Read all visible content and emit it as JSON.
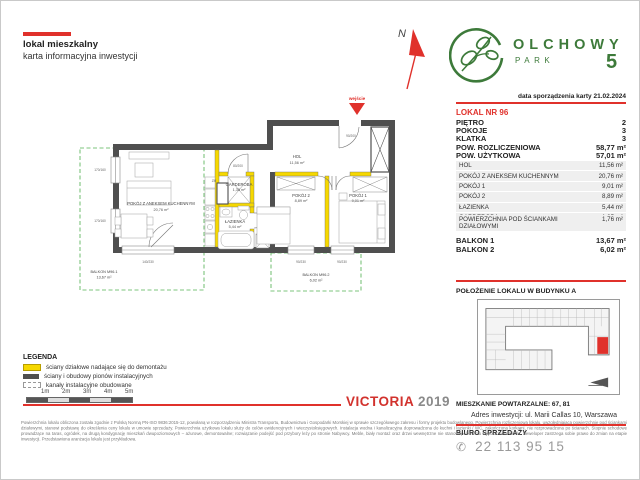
{
  "colors": {
    "accent_red": "#e0312b",
    "brand_green": "#3d7a3a",
    "wall_yellow": "#f6d800",
    "wall_gray": "#4f4f4f",
    "balcony_green": "#7cc47c"
  },
  "header": {
    "doc_type_line1": "lokal mieszkalny",
    "doc_type_line2": "karta informacyjna inwestycji",
    "compass_label": "N",
    "date_label": "data sporządzenia karty 21.02.2024"
  },
  "brand": {
    "name": "OLCHOWY",
    "sub": "PARK",
    "number": "5"
  },
  "panel": {
    "unit_title": "LOKAL NR 96",
    "summary_rows": [
      {
        "label": "PIĘTRO",
        "value": "2"
      },
      {
        "label": "POKOJE",
        "value": "3"
      },
      {
        "label": "KLATKA",
        "value": "3"
      },
      {
        "label": "POW. ROZLICZENIOWA",
        "value": "58,77 m²"
      },
      {
        "label": "POW. UŻYTKOWA",
        "value": "57,01 m²"
      }
    ],
    "room_rows": [
      {
        "label": "HOL",
        "value": "11,56 m²"
      },
      {
        "label": "POKÓJ Z ANEKSEM KUCHENNYM",
        "value": "20,76 m²"
      },
      {
        "label": "POKÓJ 1",
        "value": "9,01 m²"
      },
      {
        "label": "POKÓJ 2",
        "value": "8,89 m²"
      },
      {
        "label": "ŁAZIENKA",
        "value": "5,44 m²"
      },
      {
        "label": "GARDEROBA",
        "value": "1,35 m²"
      }
    ],
    "partition_row": {
      "label": "POWIERZCHNIA POD ŚCIANKAMI DZIAŁOWYMI",
      "value": "1,76 m²"
    },
    "balcony_rows": [
      {
        "label": "BALKON 1",
        "value": "13,67 m²"
      },
      {
        "label": "BALKON 2",
        "value": "6,02 m²"
      }
    ],
    "location_title": "POŁOŻENIE LOKALU W BUDYNKU A",
    "repeatable": "MIESZKANIE POWTARZALNE: 67, 81",
    "address": "Adres inwestycji: ul. Marii Callas 10, Warszawa",
    "sales_office_label": "BIURO SPRZEDAŻY",
    "phone": "22 113 95 15",
    "phone_icon": "✆"
  },
  "floorplan": {
    "entrance_label": "wejście",
    "kitchen_label": "ZM",
    "rooms": [
      {
        "name": "POKÓJ Z ANEKSEM KUCHENNYM",
        "area": "20,76 m²"
      },
      {
        "name": "HOL",
        "area": "11,56 m²"
      },
      {
        "name": "GARDEROBA",
        "area": "1,35 m²"
      },
      {
        "name": "ŁAZIENKA",
        "area": "5,44 m²"
      },
      {
        "name": "POKÓJ 2",
        "area": "8,89 m²"
      },
      {
        "name": "POKÓJ 1",
        "area": "9,01 m²"
      }
    ],
    "balcony1": {
      "label": "BALKON M96.1",
      "area": "13,67 m²"
    },
    "balcony2": {
      "label": "BALKON M96.2",
      "area": "6,02 m²"
    },
    "dims": [
      "170/160",
      "170/160",
      "140/230",
      "90/230",
      "90/230",
      "80/200",
      "90/200"
    ]
  },
  "legend": {
    "title": "LEGENDA",
    "items": [
      "ściany działowe nadające się do demontażu",
      "ściany i obudowy pionów instalacyjnych",
      "kanały instalacyjne obudowane"
    ],
    "scale_ticks": [
      "1m",
      "2m",
      "3m",
      "4m",
      "5m"
    ]
  },
  "victoria": {
    "brand": "VICTORIA",
    "year": "2019"
  },
  "footer_text": "Powierzchnia lokalu obliczona została zgodnie z Polską Normą PN-ISO 9836:2015-12, powołaną w rozporządzeniu Ministra Transportu, Budownictwa i Gospodarki Morskiej w sprawie szczegółowego zakresu i formy projektu budowlanego. Powierzchnia rozliczeniowa lokalu, uwzględniająca powierzchnię pod ściankami działowymi, stanowi podstawę do określenia ceny lokalu w umowie sprzedaży. Powierzchnia użytkowa lokalu służy do celów ewidencyjnych i wieczystoksięgowych. Instalacja wodna i kanalizacyjna doprowadzona do kuchni i łazienki / WC, zakończona korkami, nie rozprowadzona po ścianach. Stopnie schodowe prowadzące na taras, ogródek, na drugą kondygnację mieszkań dwupoziomowych – ażurowe, demontowalne; rozwiązanie podejść pod przybory leży po stronie Nabywcy. Meble, biały montaż oraz drzwi wewnętrzne nie stanowią elementu wyposażenia lokalu. Deweloper zastrzega sobie prawo do zmian na etapie inwestycji. Przedstawiona aranżacja lokalu jest przykładowa."
}
